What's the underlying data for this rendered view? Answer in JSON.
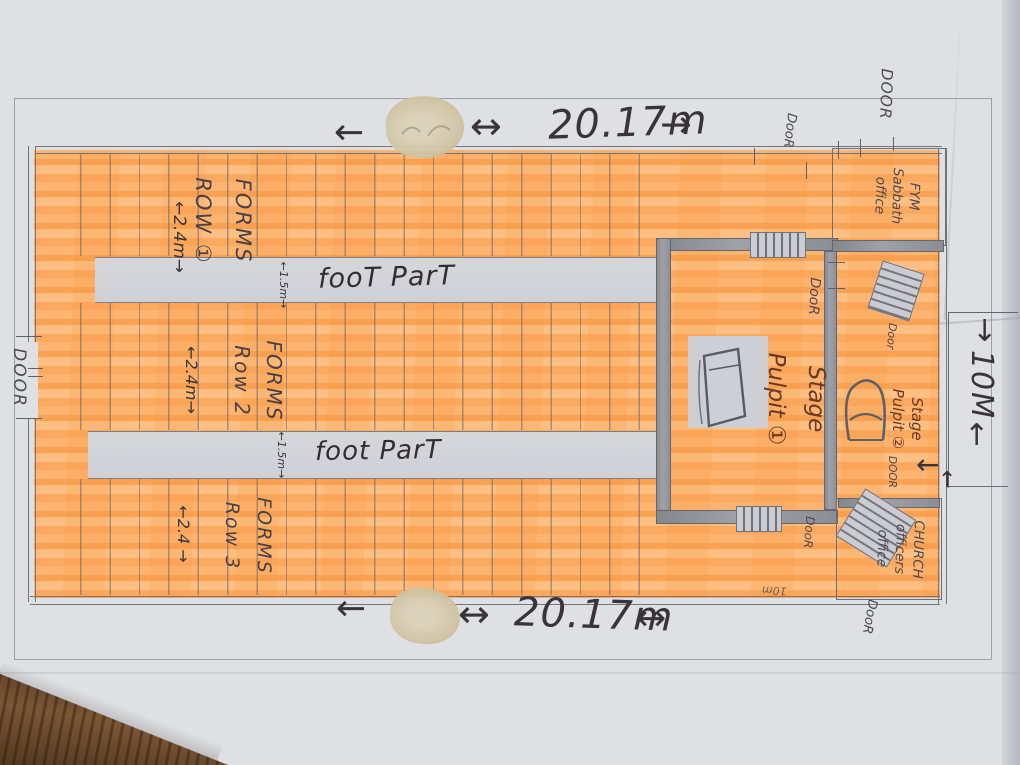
{
  "dimensions": {
    "top": {
      "arrow_left": "←",
      "arrow_double": "↔",
      "value": "20.17m",
      "arrow_right": "→"
    },
    "bottom": {
      "arrow_left": "←",
      "arrow_double_left": "↔",
      "value": "20.17m",
      "arrow_double_right": "↔"
    },
    "right": {
      "arrow_down": "↓",
      "value": "10M",
      "arrow_up": "↑",
      "arrow_left": "←",
      "arrow_up_small": "↑"
    }
  },
  "seating": {
    "row1": {
      "line1": "FORMS",
      "line2": "ROW ①",
      "width": "←2.4m→"
    },
    "row2": {
      "line1": "FORMS",
      "line2": "Row 2",
      "width": "←2.4m→"
    },
    "row3": {
      "line1": "FORMS",
      "line2": "Row 3",
      "width": "←2.4 →"
    },
    "walkway1": {
      "label": "fooT ParT",
      "width": "←1.5m→"
    },
    "walkway2": {
      "label": "foot ParT",
      "width": "←1.5m→"
    }
  },
  "rooms": {
    "stage1": {
      "line1": "Stage",
      "line2": "Pulpit ①"
    },
    "stage2": {
      "line1": "Stage",
      "line2": "Pulpit ②"
    },
    "fym_office": {
      "line1": "FYM",
      "line2": "Sabbath",
      "line3": "office"
    },
    "church_office": {
      "line1": "CHURCH",
      "line2": "officers",
      "line3": "office"
    }
  },
  "doors": {
    "left_wall": "DOOR",
    "top_wall": "DooR",
    "top_right": "DOOR",
    "stage_top": "DooR",
    "stage_bottom": "DooR",
    "stage2_top": "Door",
    "stage2_bottom": "DOOR",
    "bottom_right": "DooR"
  },
  "notes": {
    "bottom_wall": "10m"
  },
  "colors": {
    "highlight_orange": "#fbaa5e",
    "paper": "#e0e1e5",
    "pencil": "#6f717a",
    "ink": "#3a343a",
    "stage_ink": "#693827",
    "wood": "#6f4c31"
  }
}
